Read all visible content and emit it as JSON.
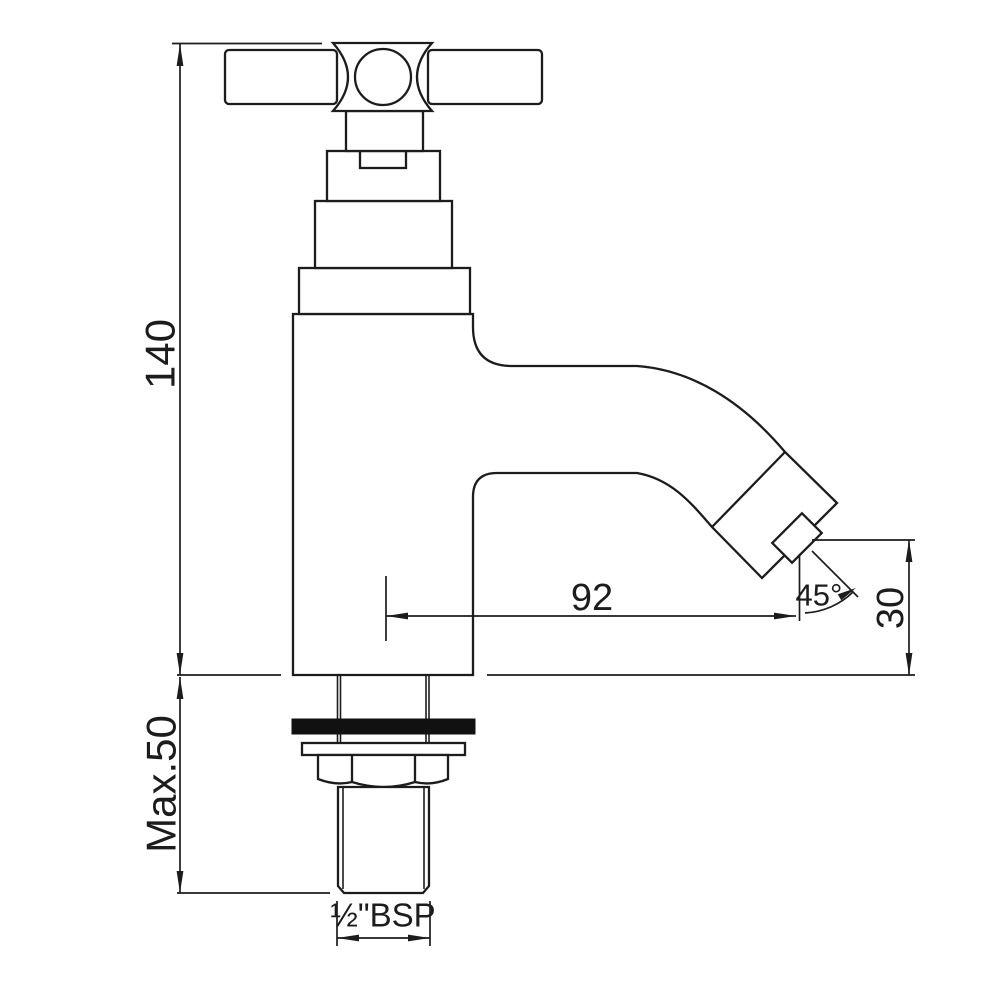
{
  "drawing": {
    "dimensions": {
      "overall_height": "140",
      "max_deck_thickness": "Max.50",
      "spout_reach": "92",
      "spout_angle": "45°",
      "outlet_height": "30",
      "thread_size": "½\"BSP"
    },
    "colors": {
      "line": "#1c1c1c",
      "background": "#ffffff",
      "washer_fill": "#111111"
    }
  }
}
